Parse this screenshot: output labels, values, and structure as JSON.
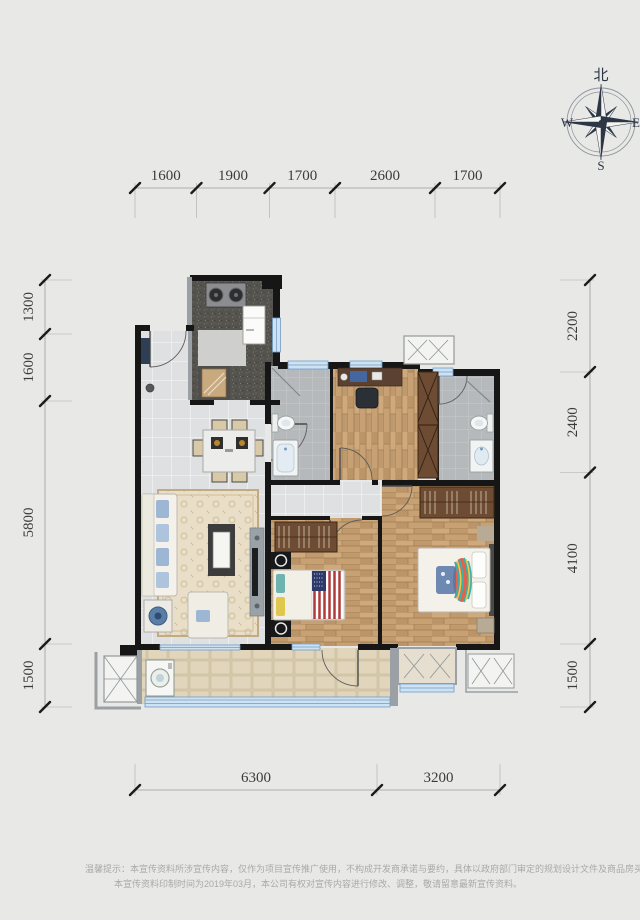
{
  "compass": {
    "north": "北",
    "west": "W",
    "east": "E",
    "south": "S"
  },
  "dimensions": {
    "top": [
      "1600",
      "1900",
      "1700",
      "2600",
      "1700"
    ],
    "bottom": [
      "6300",
      "3200"
    ],
    "left": [
      "1300",
      "1600",
      "5800",
      "1500"
    ],
    "right": [
      "2200",
      "2400",
      "4100",
      "1500"
    ]
  },
  "disclaimer": {
    "line1": "温馨提示：本宣传资料所涉宣传内容，仅作为项目宣传推广使用，不构成开发商承诺与要约，具体以政府部门审定的规划设计文件及商品房买卖合同约",
    "line2": "本宣传资料印制时间为2019年03月，本公司有权对宣传内容进行修改、调整，敬请留意最新宣传资料。"
  },
  "colors": {
    "background": "#e8e8e7",
    "wall": "#161616",
    "window_blue": "#cfe2f2",
    "window_frame": "#6e9cc7",
    "wood_floor": "#c9a57a",
    "tile_floor": "#dee0e1",
    "bath_floor": "#b5b9bb",
    "balcony_floor": "#decfb2",
    "kitchen_counter": "#55534e",
    "wardrobe": "#6e4c33",
    "rug": "#e9dfc8",
    "dimension_text": "#3b3b3b",
    "disclaimer_text": "#a9a9a7",
    "compass_ink": "#2c3644"
  }
}
